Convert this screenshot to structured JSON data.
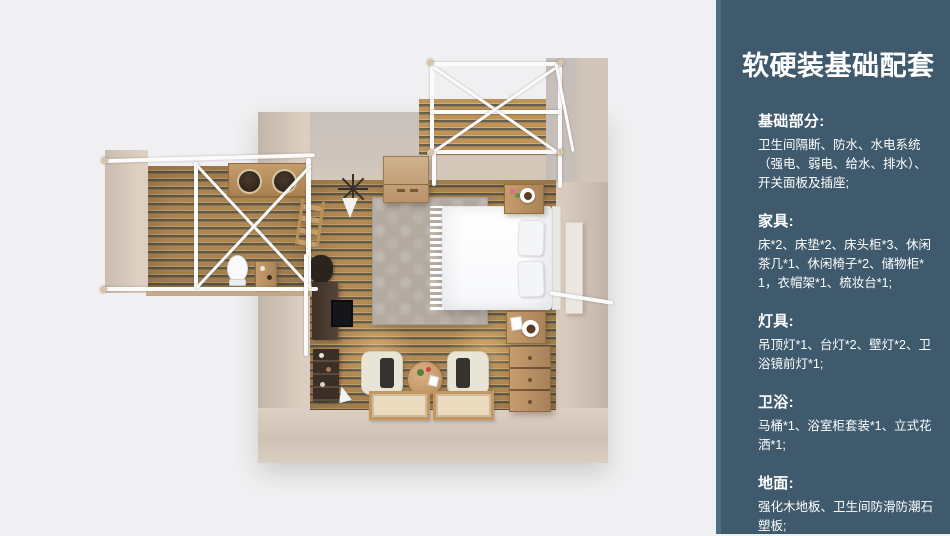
{
  "panel": {
    "title": "软硬装基础配套",
    "bg_color": "#3e5a6c",
    "edge_accent_color": "#4e6d84",
    "text_color": "#ffffff",
    "sections": [
      {
        "heading": "基础部分:",
        "body": "卫生间隔断、防水、水电系统（强电、弱电、给水、排水）、开关面板及插座;"
      },
      {
        "heading": "家具:",
        "body": "床*2、床垫*2、床头柜*3、休闲茶几*1、休闲椅子*2、储物柜*1，衣帽架*1、梳妆台*1;"
      },
      {
        "heading": "灯具:",
        "body": "吊顶灯*1、台灯*2、壁灯*2、卫浴镜前灯*1;"
      },
      {
        "heading": "卫浴:",
        "body": "马桶*1、浴室柜套装*1、立式花洒*1;"
      },
      {
        "heading": "地面:",
        "body": "强化木地板、卫生间防滑防潮石塑板;"
      }
    ]
  },
  "floorplan": {
    "type": "3d-top-down-room-render",
    "rooms": [
      "bedroom",
      "bathroom-annex",
      "deck"
    ],
    "colors": {
      "background": "#f0f0f2",
      "wall": "#cfc1b5",
      "floor_wood": "#b28b55",
      "frame_white": "#fbfbfb",
      "bed": "#ffffff",
      "rug": "#b3aaa0"
    }
  }
}
